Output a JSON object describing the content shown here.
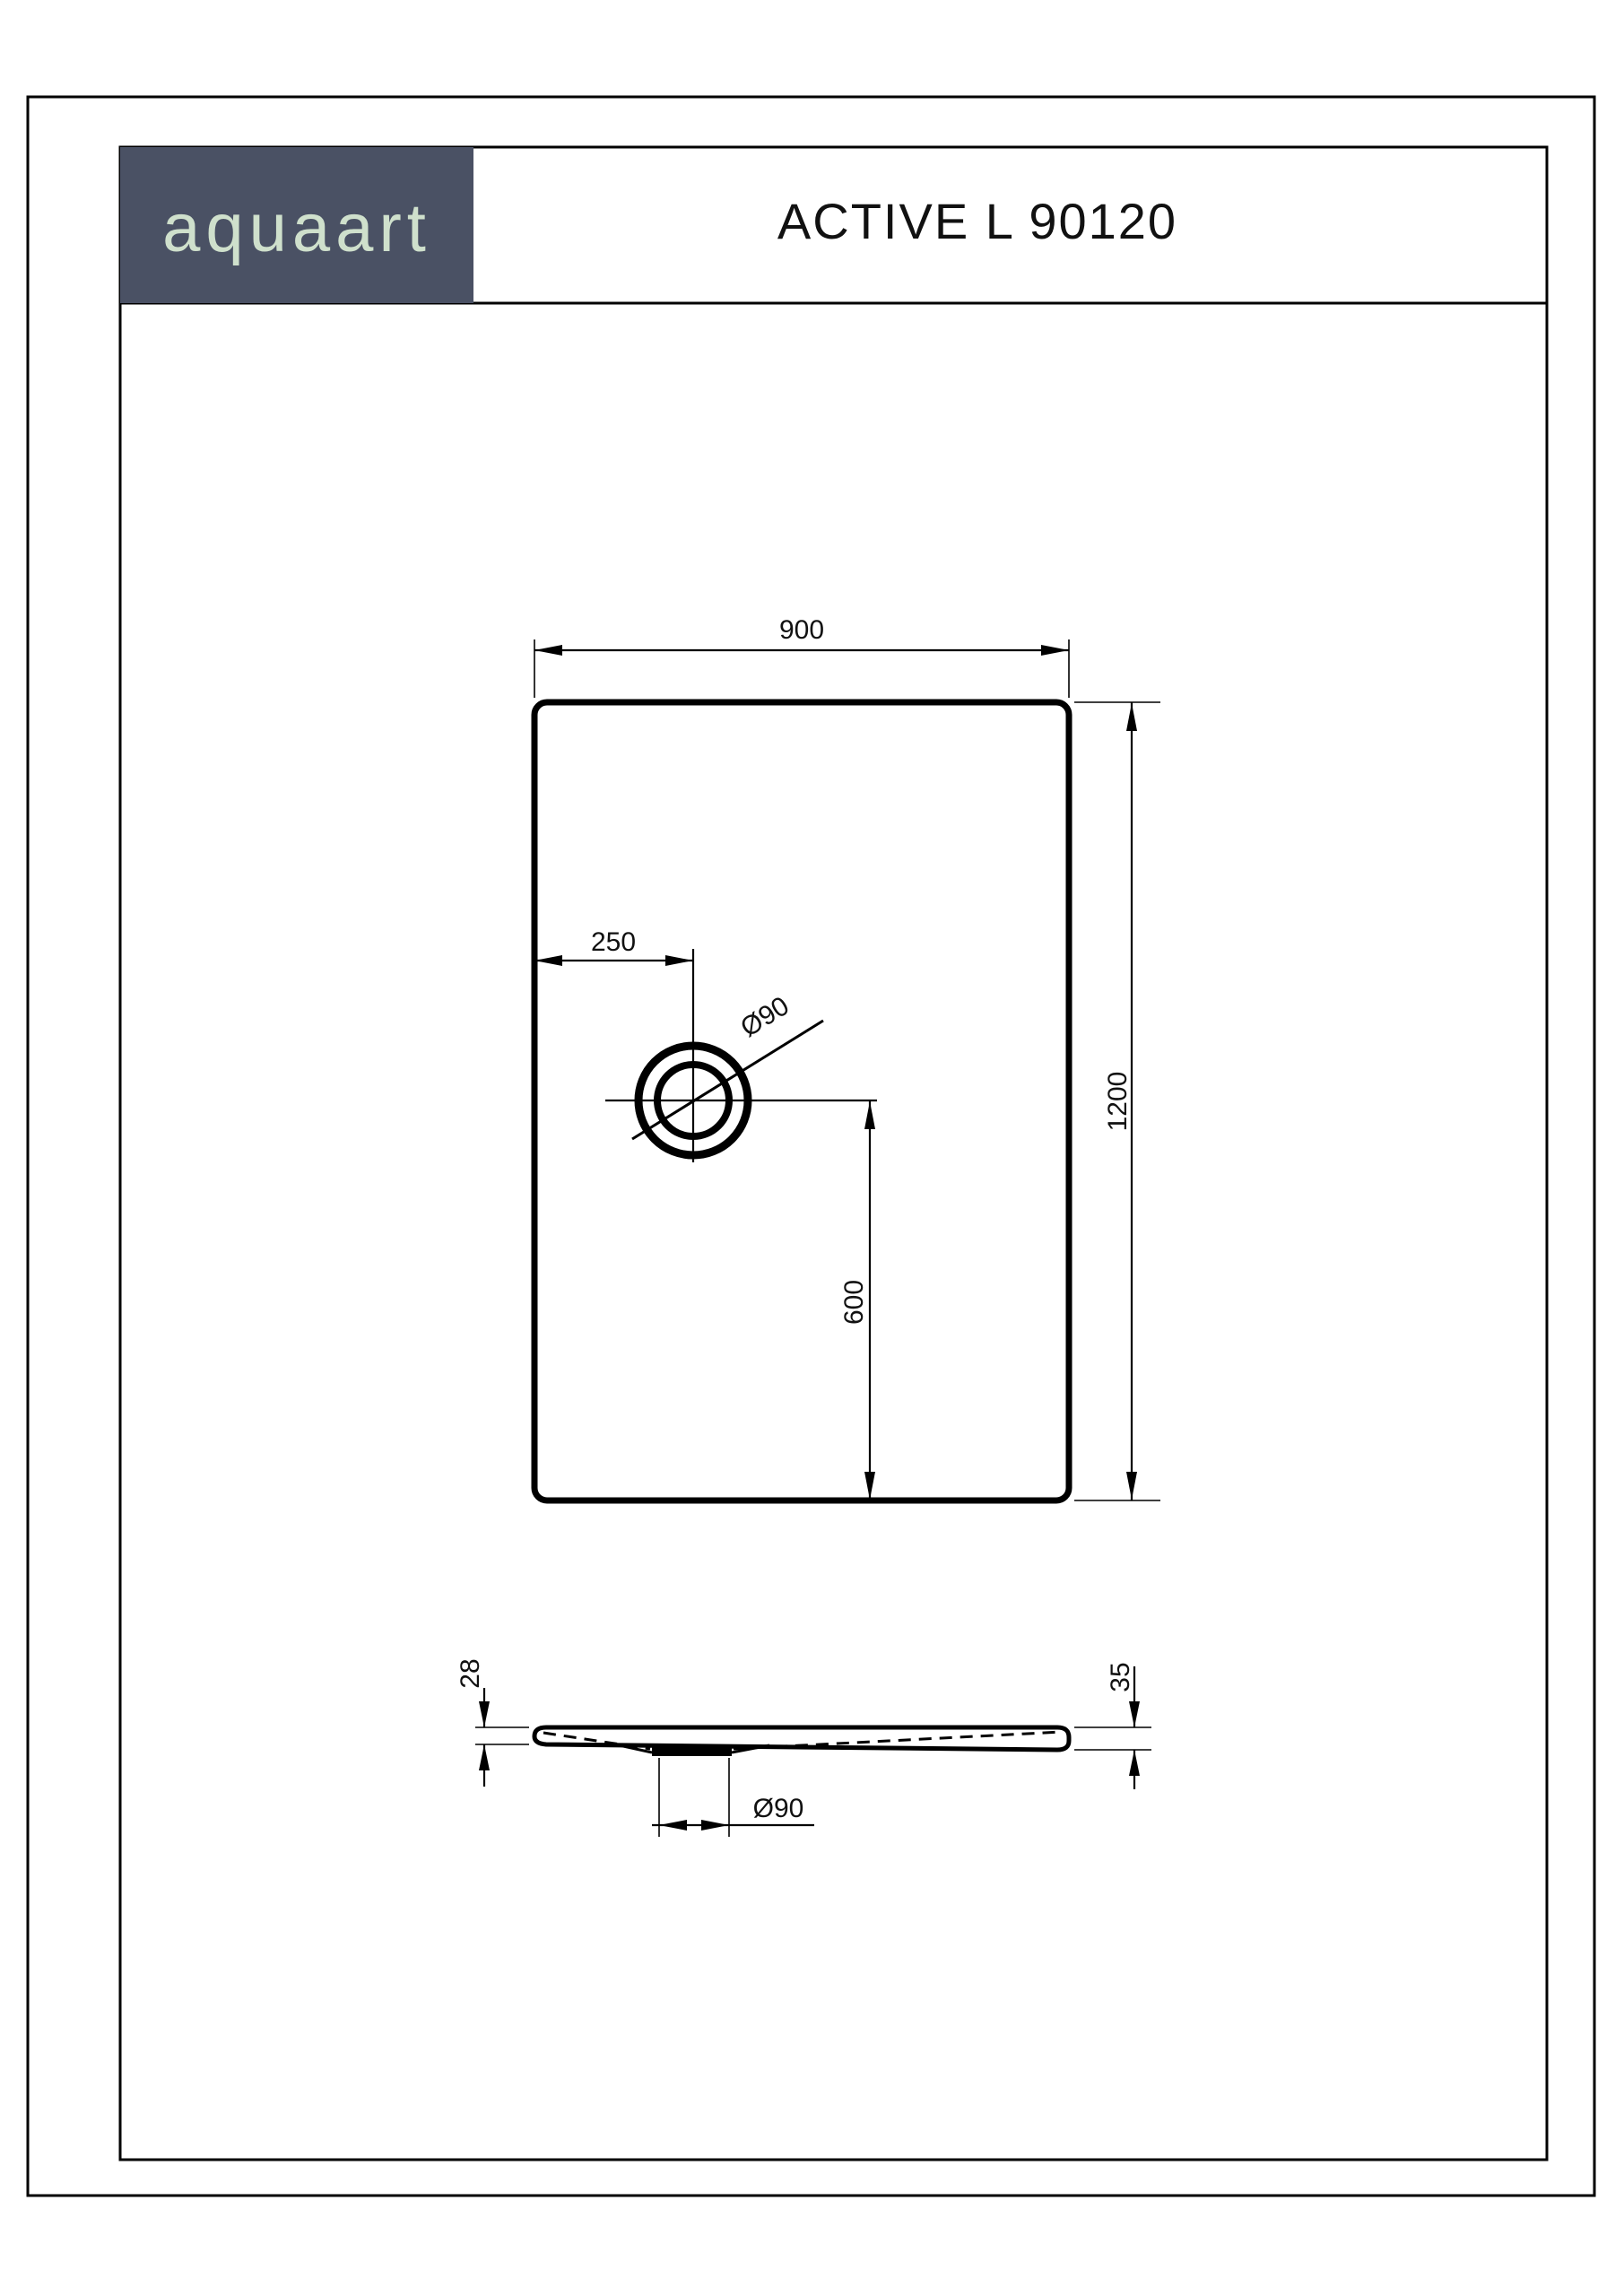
{
  "document": {
    "brand": "aquaart",
    "title": "ACTIVE L 90120"
  },
  "colors": {
    "logo_bg": "#4a5164",
    "logo_text": "#cfe0cc",
    "line": "#000000"
  },
  "plan_view": {
    "width_label": "900",
    "height_label": "1200",
    "drain_offset_left_label": "250",
    "drain_offset_bottom_label": "600",
    "drain_diameter_label": "Ø90"
  },
  "section_view": {
    "left_edge_height_label": "28",
    "right_edge_height_label": "35",
    "drain_diameter_label": "Ø90"
  }
}
